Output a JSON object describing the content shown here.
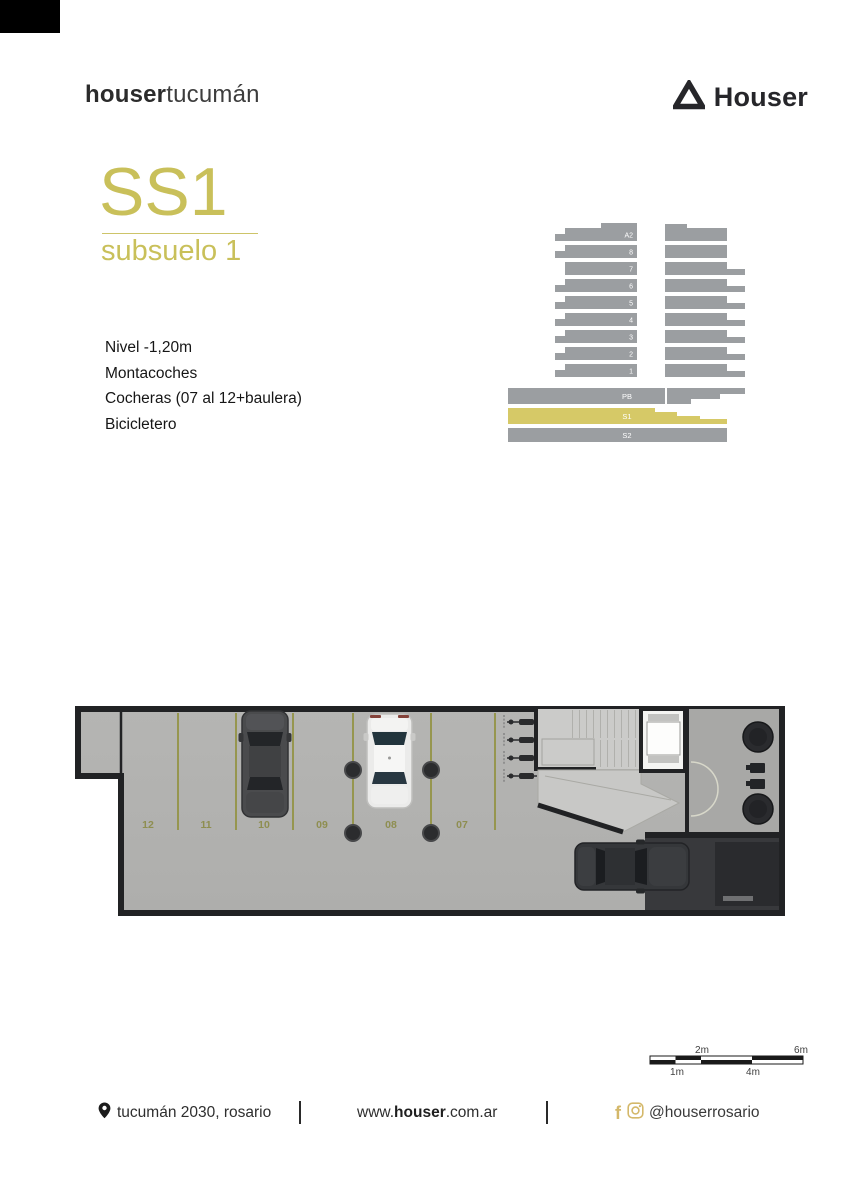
{
  "header": {
    "brand_bold": "houser",
    "brand_light": "tucumán",
    "logo_text": "Houser"
  },
  "title": {
    "code": "SS1",
    "subtitle": "subsuelo 1"
  },
  "features": [
    "Nivel -1,20m",
    "Montacoches",
    "Cocheras (07 al 12+baulera)",
    "Bicicletero"
  ],
  "section": {
    "floors": [
      "A2",
      "8",
      "7",
      "6",
      "5",
      "4",
      "3",
      "2",
      "1"
    ],
    "levels": [
      "PB",
      "S1",
      "S2"
    ],
    "highlighted_level": "S1",
    "colors": {
      "bar": "#9b9ea1",
      "highlight": "#d6c967",
      "label": "#ffffff"
    }
  },
  "plan": {
    "spots": [
      "12",
      "11",
      "10",
      "09",
      "08",
      "07"
    ],
    "colors": {
      "wall": "#212224",
      "floor": "#b2b2b0",
      "stall_line": "#96964f",
      "stall_label": "#8e8e50",
      "stairs": "#cbcbc9",
      "ramp": "#38393c"
    }
  },
  "scale": {
    "top": [
      "2m",
      "6m"
    ],
    "bottom": [
      "1m",
      "4m"
    ]
  },
  "footer": {
    "address": "tucumán 2030, rosario",
    "web_prefix": "www.",
    "web_bold": "houser",
    "web_suffix": ".com.ar",
    "social_handle": "@houserrosario"
  },
  "colors": {
    "accent_olive": "#c9c05a",
    "social_gold": "#d4b86a",
    "logo_dark": "#26262a"
  }
}
